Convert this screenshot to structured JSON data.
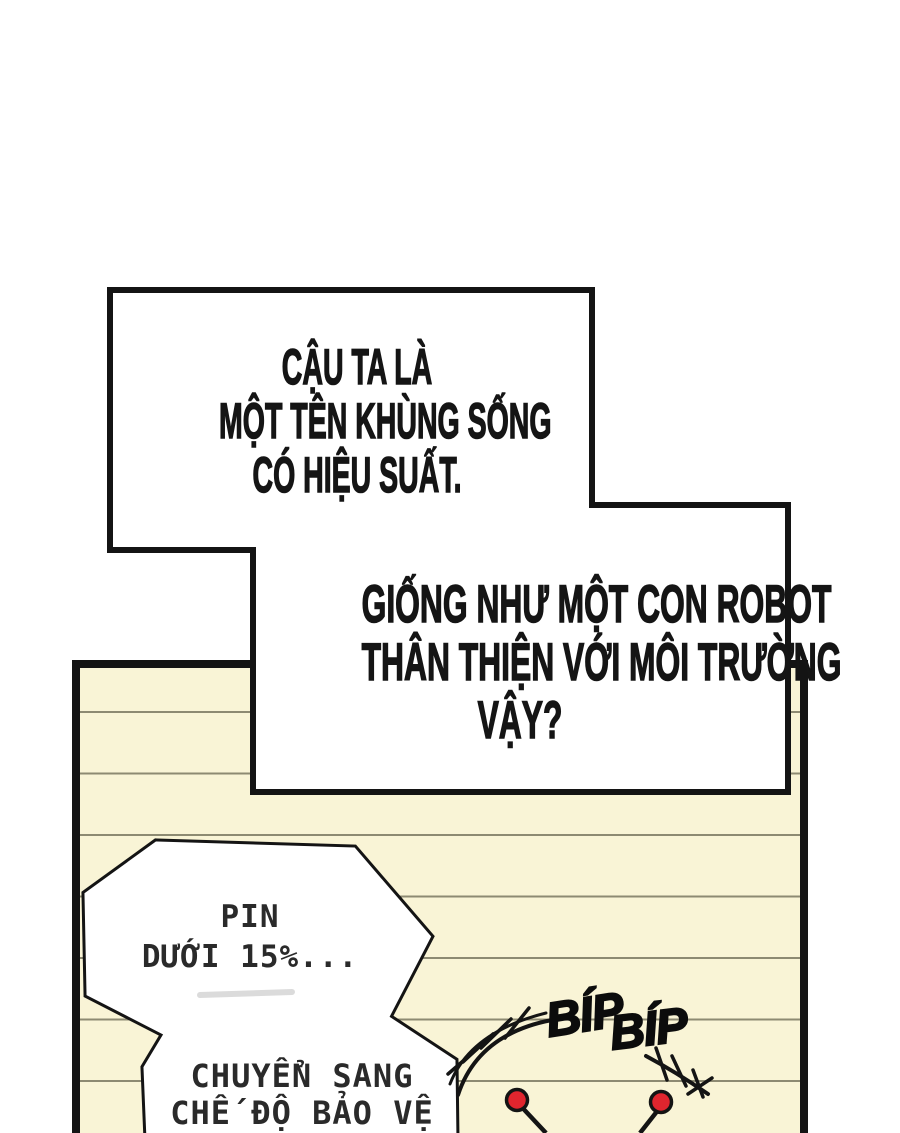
{
  "colors": {
    "ink": "#151515",
    "page_background": "#ffffff",
    "panel_fill": "#f9f4d6",
    "panel_line": "#8d8a72",
    "bubble_fill": "#ffffff",
    "antenna_tip": "#e0252e",
    "smudge": "#c9c9c9"
  },
  "narration_box_1": {
    "lines": [
      "CẬU TA LÀ",
      "MỘT TÊN KHÙNG SỐNG",
      "CÓ HIỆU SUẤT."
    ]
  },
  "narration_box_2": {
    "lines": [
      "GIỐNG NHƯ MỘT CON ROBOT",
      "THÂN THIỆN VỚI MÔI TRƯỜNG",
      "VẬY?"
    ]
  },
  "robot_bubble": {
    "upper_lines": [
      "PIN",
      "DƯỚI 15%..."
    ],
    "lower_lines": [
      "CHUYỂN SANG",
      "CHẾ ĐỘ BẢO VỆ"
    ]
  },
  "sfx": {
    "words": [
      "BÍP",
      "BÍP"
    ]
  }
}
